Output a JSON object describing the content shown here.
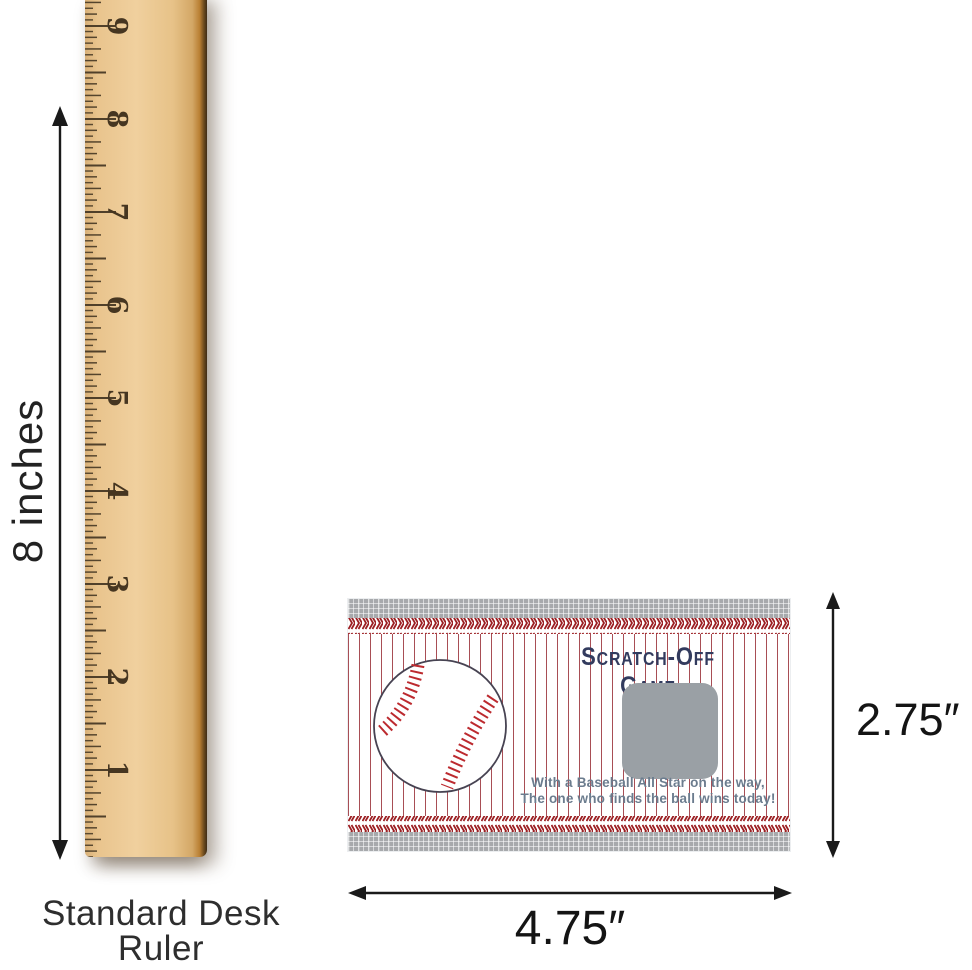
{
  "canvas": {
    "background": "#ffffff"
  },
  "ruler": {
    "numbers": [
      "9",
      "8",
      "7",
      "6",
      "5",
      "4",
      "3",
      "2",
      "1"
    ],
    "height_label": "8 inches",
    "caption_line1": "Standard Desk Ruler",
    "caption_line2": "Inches",
    "wood_color": "#eec791",
    "tick_color": "#50402a"
  },
  "card": {
    "title": "Scratch-Off Game",
    "message_line1": "With a Baseball All Star on the way,",
    "message_line2": "The one who finds the ball wins today!",
    "height_label": "2.75″",
    "width_label": "4.75″",
    "colors": {
      "pinstripe_red": "#a84e55",
      "stitch_red": "#9c1f23",
      "gingham_gray": "#a7a9ac",
      "scratch_panel_gray": "#9aa0a5",
      "title_navy": "#323b5e",
      "message_slate": "#6b7c8e"
    }
  }
}
